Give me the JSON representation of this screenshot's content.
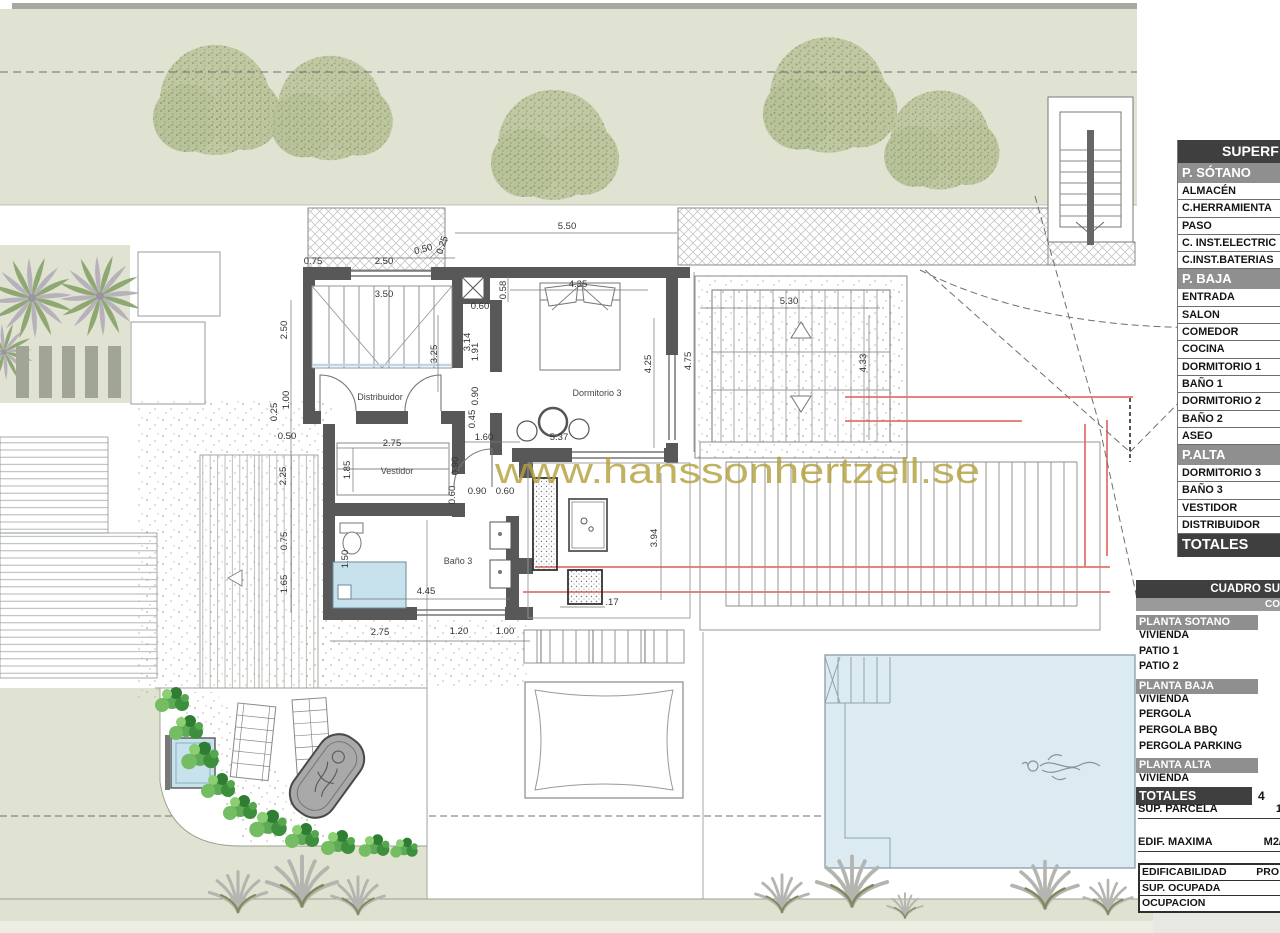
{
  "plan": {
    "watermark": "www.hanssonhertzell.se",
    "rooms": [
      {
        "name": "Distribuidor"
      },
      {
        "name": "Dormitorio 3"
      },
      {
        "name": "Vestidor"
      },
      {
        "name": "Baño 3"
      }
    ],
    "dims": [
      {
        "t": "5.50"
      },
      {
        "t": "0.75"
      },
      {
        "t": "2.50"
      },
      {
        "t": "0.50"
      },
      {
        "t": "0.25"
      },
      {
        "t": "3.50"
      },
      {
        "t": "0.58"
      },
      {
        "t": "4.35"
      },
      {
        "t": "0.60"
      },
      {
        "t": "3.25"
      },
      {
        "t": "3.14"
      },
      {
        "t": "1.91"
      },
      {
        "t": "4.25"
      },
      {
        "t": "4.75"
      },
      {
        "t": "5.30"
      },
      {
        "t": "4.33"
      },
      {
        "t": "2.50"
      },
      {
        "t": "1.00"
      },
      {
        "t": "0.25"
      },
      {
        "t": "0.50"
      },
      {
        "t": "2.25"
      },
      {
        "t": "0.75"
      },
      {
        "t": "1.65"
      },
      {
        "t": "0.90"
      },
      {
        "t": "0.45"
      },
      {
        "t": "1.60"
      },
      {
        "t": "5.37"
      },
      {
        "t": "2.75"
      },
      {
        "t": "1.85"
      },
      {
        "t": "0.90"
      },
      {
        "t": "0.60"
      },
      {
        "t": "0.90"
      },
      {
        "t": "0.60"
      },
      {
        "t": "1.50"
      },
      {
        "t": "4.45"
      },
      {
        "t": "3.94"
      },
      {
        "t": ".17"
      },
      {
        "t": "2.75"
      },
      {
        "t": "1.20"
      },
      {
        "t": "1.00"
      }
    ]
  },
  "tables": {
    "superficies": {
      "title": "SUPERF",
      "sections": [
        {
          "header": "P. SÓTANO",
          "rows": [
            "ALMACÉN",
            "C.HERRAMIENTA",
            "PASO",
            "C. INST.ELECTRIC",
            "C.INST.BATERIAS"
          ]
        },
        {
          "header": "P. BAJA",
          "rows": [
            "ENTRADA",
            "SALON",
            "COMEDOR",
            "COCINA",
            "DORMITORIO 1",
            "BAÑO 1",
            "DORMITORIO 2",
            "BAÑO 2",
            "ASEO"
          ]
        },
        {
          "header": "P.ALTA",
          "rows": [
            "DORMITORIO 3",
            "BAÑO 3",
            "VESTIDOR",
            "DISTRIBUIDOR"
          ]
        }
      ],
      "footer": "TOTALES"
    },
    "cuadro": {
      "title": "CUADRO SU",
      "col_header": "CO",
      "sections": [
        {
          "header": "PLANTA SOTANO",
          "rows": [
            "VIVIENDA",
            "PATIO 1",
            "PATIO 2"
          ]
        },
        {
          "header": "PLANTA BAJA",
          "rows": [
            "VIVIENDA",
            "PERGOLA",
            "PERGOLA BBQ",
            "PERGOLA PARKING"
          ]
        },
        {
          "header": "PLANTA ALTA",
          "rows": [
            "VIVIENDA"
          ]
        }
      ],
      "footer": "TOTALES",
      "footer_value": "4"
    },
    "info": {
      "parcela_label": "SUP. PARCELA",
      "parcela_value": "1",
      "edif_label": "EDIF. MAXIMA",
      "edif_value": "M2/",
      "box": [
        {
          "label": "EDIFICABILIDAD",
          "value": "PRO"
        },
        {
          "label": "SUP. OCUPADA",
          "value": ""
        },
        {
          "label": "OCUPACION",
          "value": ""
        }
      ]
    }
  },
  "colors": {
    "sage": "#e0e3d1",
    "wall": "#585858",
    "pool": "#dcebf2",
    "red_line": "#e2736b",
    "watermark": "#b3a23e",
    "header_dark": "#3f3f3f",
    "header_gray": "#8f8f8f"
  }
}
